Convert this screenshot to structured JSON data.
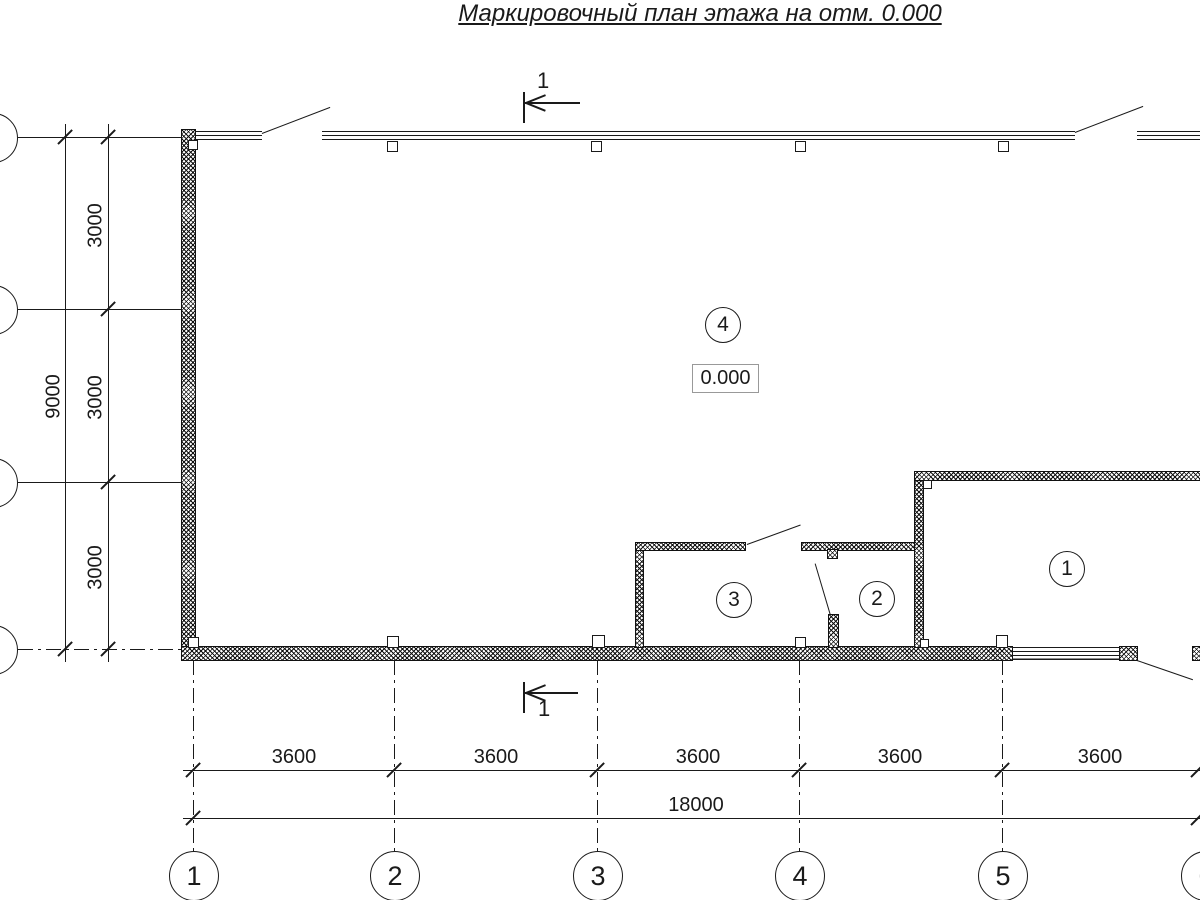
{
  "title": "Маркировочный план этажа на отм. 0.000",
  "elevation_box": {
    "value": "0.000"
  },
  "rooms": {
    "r1": "1",
    "r2": "2",
    "r3": "3",
    "r4": "4"
  },
  "section_mark": {
    "top_label": "1",
    "bottom_label": "1"
  },
  "axes_bottom": [
    "1",
    "2",
    "3",
    "4",
    "5",
    "6"
  ],
  "dims": {
    "col_spacing": [
      "3600",
      "3600",
      "3600",
      "3600",
      "3600"
    ],
    "col_total": "18000",
    "row_spacing": [
      "3000",
      "3000",
      "3000"
    ],
    "row_total": "9000"
  },
  "colors": {
    "line": "#1a1a1a",
    "background": "#ffffff"
  }
}
